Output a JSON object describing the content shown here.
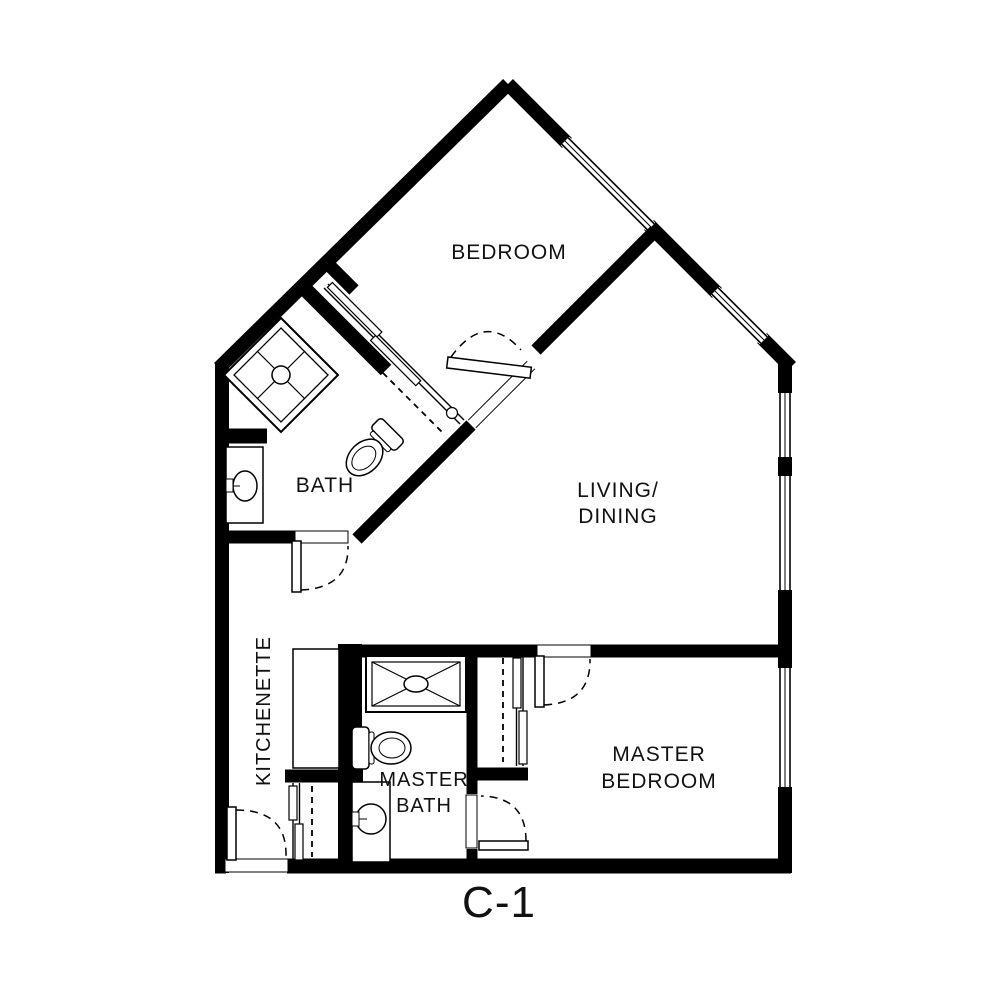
{
  "plan": {
    "code": "C-1",
    "kind": "apartment-unit-floor-plan",
    "ink_color": "#000000",
    "paper_color": "#ffffff"
  },
  "rooms": {
    "bedroom": {
      "label": "BEDROOM"
    },
    "living_dining": {
      "line1": "LIVING/",
      "line2": "DINING"
    },
    "bath": {
      "label": "BATH"
    },
    "kitchenette": {
      "label": "KITCHENETTE"
    },
    "master_bath": {
      "line1": "MASTER",
      "line2": "BATH"
    },
    "master_bedroom": {
      "line1": "MASTER",
      "line2": "BEDROOM"
    }
  },
  "fixtures": {
    "bath": [
      "corner-shower",
      "toilet",
      "vanity-sink"
    ],
    "master_bath": [
      "shower",
      "toilet",
      "vanity-sink"
    ],
    "kitchenette": [
      "counter"
    ],
    "closets": [
      "bedroom-closet-sliding",
      "entry-closet-sliding",
      "master-bedroom-closet-sliding"
    ]
  },
  "doors": [
    "entry-door",
    "bath-door",
    "bedroom-door",
    "master-bedroom-door",
    "master-bath-door"
  ],
  "windows_count": 5
}
